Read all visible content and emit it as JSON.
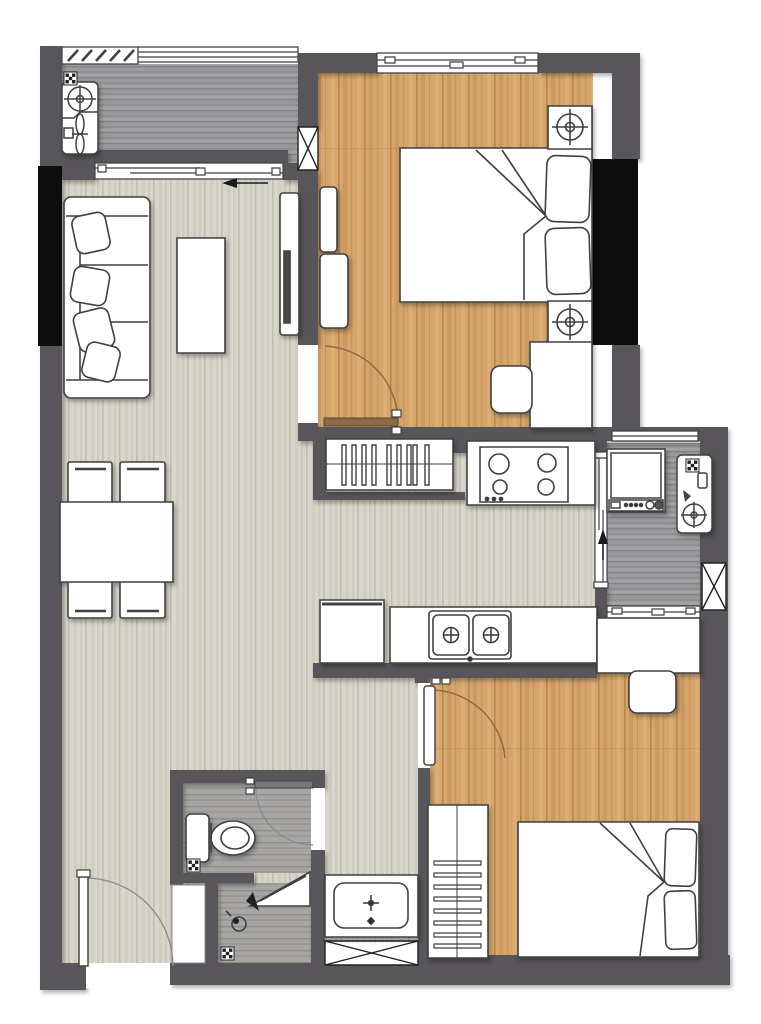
{
  "floor_plan": {
    "kind": "apartment-floor-plan",
    "rooms": [
      {
        "id": "balcony-top",
        "floor": "gray-wood",
        "items": [
          "louver-window",
          "window",
          "laundry-basin-faucet",
          "fan-fixture",
          "floor-drain",
          "sliding-door-to-living"
        ]
      },
      {
        "id": "bedroom-1",
        "floor": "wood-plank",
        "items": [
          "double-bed",
          "pillow",
          "pillow",
          "blanket-fold",
          "nightstand-with-lamp",
          "nightstand-with-lamp",
          "wardrobe-panels",
          "desk",
          "chair",
          "sliding-window",
          "swing-door"
        ]
      },
      {
        "id": "living-dining",
        "floor": "light-wood",
        "items": [
          "sofa-3-seat",
          "cushion",
          "cushion",
          "cushion",
          "cushion",
          "coffee-table",
          "tv-console",
          "tv",
          "dining-table",
          "dining-chair",
          "dining-chair",
          "dining-chair",
          "dining-chair",
          "entrance-door"
        ]
      },
      {
        "id": "kitchen",
        "floor": "light-wood",
        "items": [
          "slatted-tall-cabinet",
          "cooktop-4-burner",
          "counter",
          "double-sink-with-faucets",
          "refrigerator"
        ]
      },
      {
        "id": "utility-balcony",
        "floor": "gray-wood",
        "items": [
          "washing-machine",
          "laundry-basin-faucet",
          "floor-drain",
          "sliding-door",
          "shaft-x-box"
        ]
      },
      {
        "id": "bedroom-2",
        "floor": "wood-plank",
        "items": [
          "double-bed",
          "pillow",
          "pillow",
          "blanket-fold",
          "louvered-wardrobe",
          "desk",
          "chair",
          "interior-window",
          "swing-door"
        ]
      },
      {
        "id": "bathroom",
        "floor": "gray-tile",
        "items": [
          "toilet",
          "corner-shower-shelf",
          "shower-mixer",
          "floor-drain",
          "floor-drain",
          "swing-door",
          "service-niche"
        ]
      },
      {
        "id": "corridor",
        "floor": "light-wood",
        "items": [
          "vanity-counter",
          "basin-with-faucet",
          "shaft-x-box"
        ]
      }
    ],
    "doors": [
      "entrance-door",
      "bedroom-1-door",
      "bedroom-2-door",
      "bathroom-door",
      "balcony-sliding-door",
      "utility-sliding-door"
    ],
    "structure": [
      "shear-column-left",
      "shear-column-right",
      "shaft-x-box-top",
      "ac-shaft-x-box-right"
    ],
    "annotations": {
      "living_arrow_direction": "left",
      "utility_arrow_direction": "up"
    }
  },
  "colors": {
    "wall": "#58575a",
    "structure-black": "#0e0e0e",
    "wood-floor": "#d5a56c",
    "wood-floor-line": "#b9874e",
    "light-floor": "#d8d6ca",
    "light-floor-line": "#c0beaf",
    "balcony-floor": "#9b9a9c",
    "balcony-floor-line": "#85848a",
    "tile-floor": "#a7a6a4",
    "tile-floor-line": "#8f8e8c",
    "furniture-fill": "#ffffff",
    "furniture-line": "#3f3f3f",
    "door-arc": "#8a6a48",
    "annotation": "#1a1a1a"
  }
}
